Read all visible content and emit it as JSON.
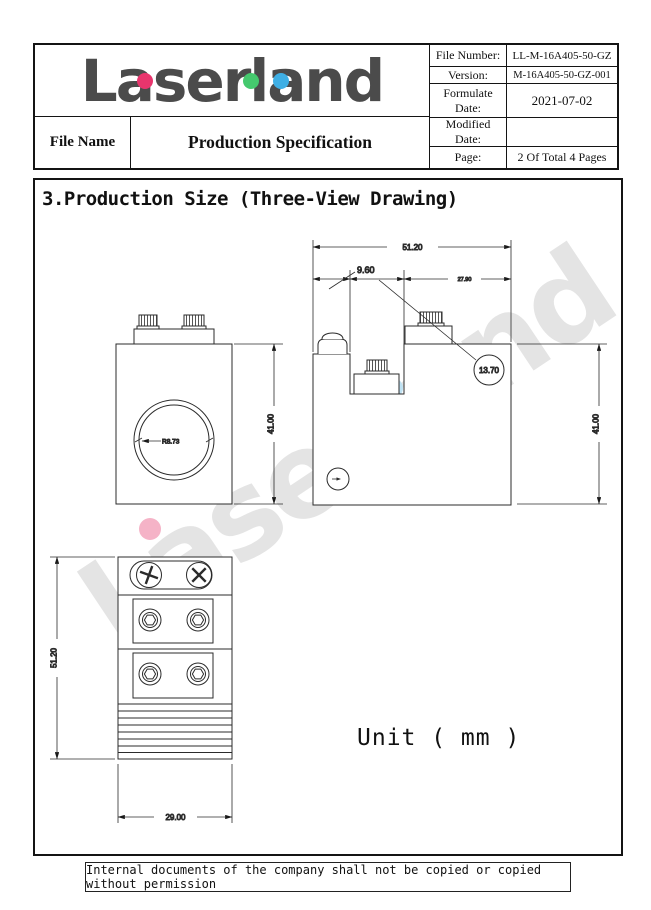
{
  "header": {
    "logo_text": "Laserland",
    "file_name_label": "File Name",
    "doc_title": "Production Specification",
    "fields": [
      {
        "label": "File Number:",
        "value": "LL-M-16A405-50-GZ"
      },
      {
        "label": "Version:",
        "value": "M-16A405-50-GZ-001"
      },
      {
        "label": "Formulate Date:",
        "value": "2021-07-02"
      },
      {
        "label": "Modified Date:",
        "value": ""
      },
      {
        "label": "Page:",
        "value": "2 Of Total 4 Pages"
      }
    ]
  },
  "section": {
    "title": "3.Production Size (Three-View Drawing)"
  },
  "drawing": {
    "watermark": "Laserland",
    "unit_label": "Unit ( mm )",
    "dimensions": {
      "front_height": "41.00",
      "lens_radius": "R8.73",
      "side_total_width": "51.20",
      "side_left_offset": "9.60",
      "side_mid_width": "13.70",
      "side_right_width": "27.90",
      "side_height": "41.00",
      "bottom_length": "51.20",
      "bottom_width": "29.00"
    }
  },
  "footer": {
    "notice": "Internal documents of the company shall not be copied or copied without permission"
  },
  "colors": {
    "logo_pink": "#E8356D",
    "logo_green": "#45C96E",
    "logo_blue": "#3FAFE4"
  }
}
